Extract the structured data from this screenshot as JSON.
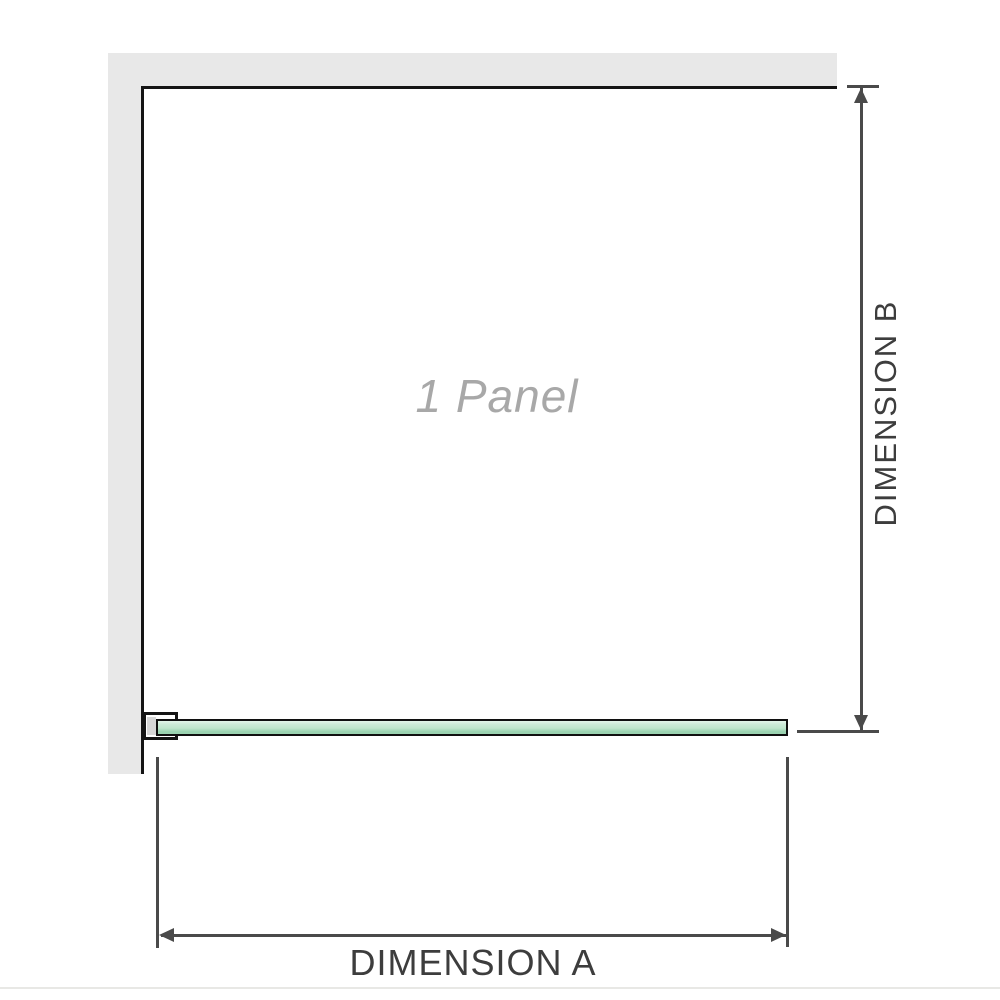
{
  "diagram": {
    "panel_label": "1 Panel",
    "dimension_a_label": "DIMENSION A",
    "dimension_b_label": "DIMENSION B"
  },
  "icons": {
    "dimension_b_arrows": "double-headed-vertical-arrow",
    "dimension_a_arrows": "double-headed-horizontal-arrow"
  },
  "colors": {
    "background": "#ffffff",
    "wall_fill": "#e8e8e8",
    "panel_outline": "#141414",
    "dimension_lines": "#4a4a4a",
    "dimension_text": "#3d3d3d",
    "panel_label_text": "#a8a8a8",
    "glass_highlight": "#e4f5ea",
    "glass_fill": "#bfe6cc",
    "glass_shade": "#9bd3b1",
    "bracket_pad": "#d6d6d6",
    "bottom_divider": "#e8e8e5"
  }
}
